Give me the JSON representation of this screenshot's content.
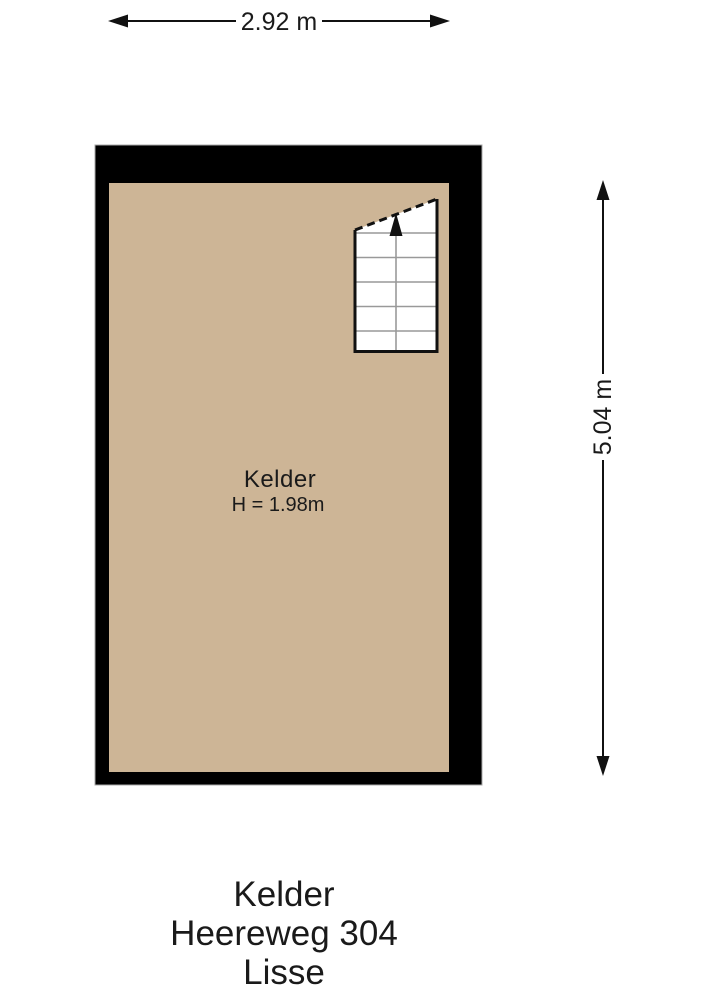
{
  "dimensions": {
    "width": {
      "label": "2.92 m"
    },
    "height": {
      "label": "5.04 m"
    }
  },
  "room": {
    "name": "Kelder",
    "ceiling_height": "H = 1.98m",
    "floor_color": "#cdb596",
    "wall_color": "#000000",
    "stair_line_color": "#999999"
  },
  "caption": {
    "room": "Kelder",
    "address": "Heereweg 304",
    "city": "Lisse"
  }
}
